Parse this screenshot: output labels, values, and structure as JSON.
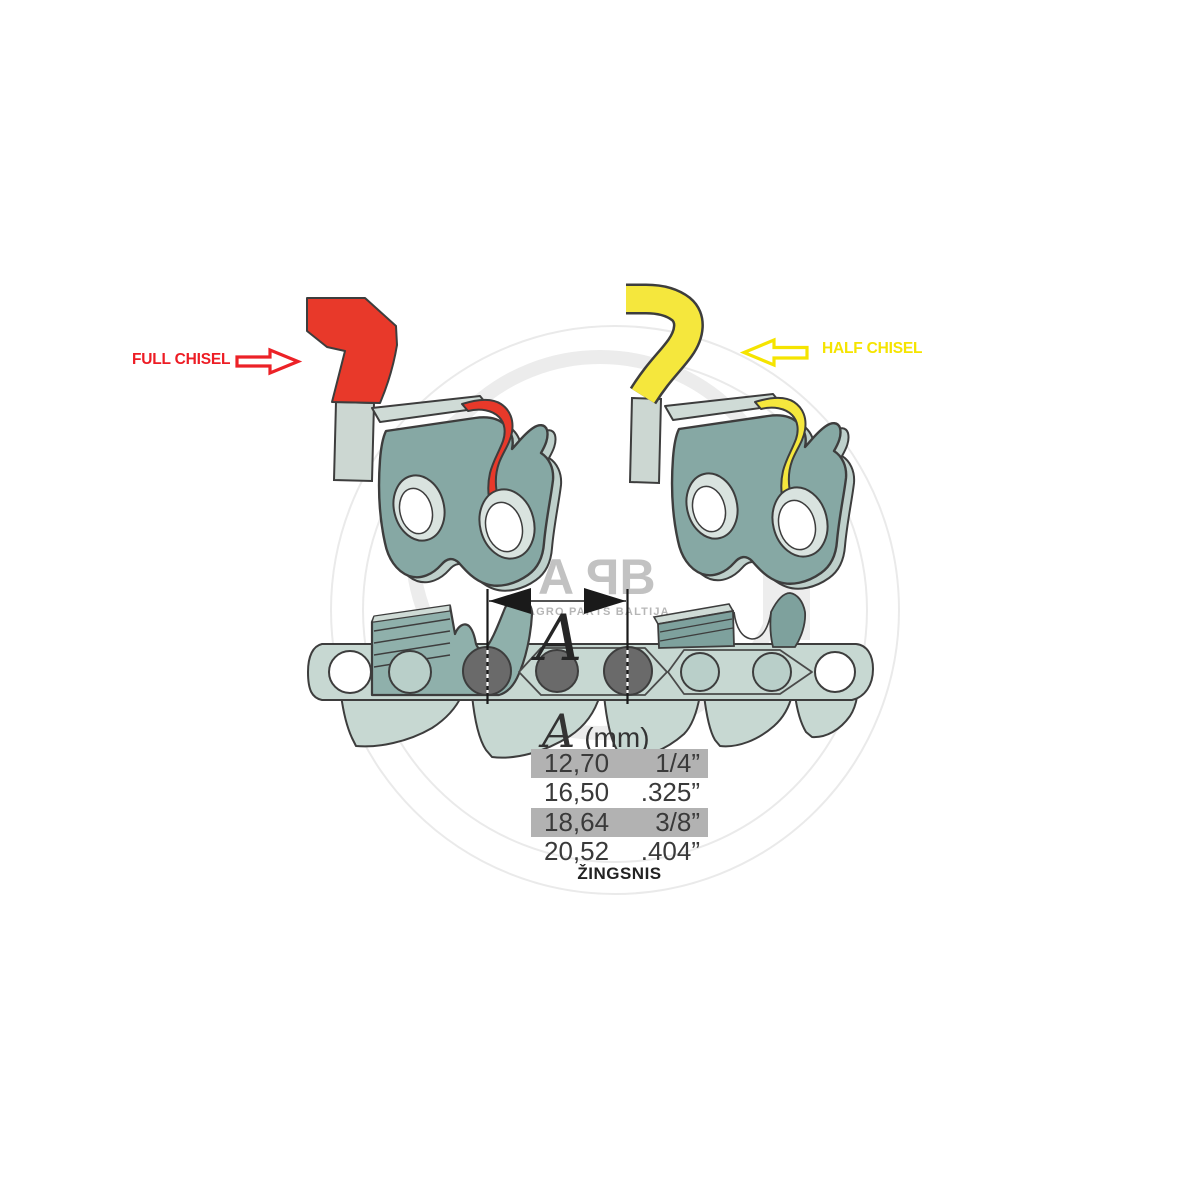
{
  "annotations": {
    "full_chisel_label": "FULL CHISEL",
    "half_chisel_label": "HALF CHISEL",
    "dimension_letter": "A"
  },
  "pitch_table": {
    "header_letter": "A",
    "header_unit": "(mm)",
    "rows": [
      {
        "mm": "12,70",
        "inch": "1/4”",
        "highlighted": true
      },
      {
        "mm": "16,50",
        "inch": ".325”",
        "highlighted": false
      },
      {
        "mm": "18,64",
        "inch": "3/8”",
        "highlighted": true
      },
      {
        "mm": "20,52",
        "inch": ".404”",
        "highlighted": false
      }
    ],
    "caption": "ŽINGSNIS"
  },
  "watermark": {
    "logo_a": "A",
    "logo_p": "P",
    "logo_b": "B",
    "tagline": "AGRO PARTS BALTIJA"
  },
  "icons": {
    "full_chisel_arrow": "arrow-right-outline-icon",
    "half_chisel_arrow": "arrow-left-outline-icon",
    "dimension_arrows": "double-headed-dimension-arrow-icon"
  },
  "colors": {
    "full_chisel_red": "#e8392a",
    "red_text": "#ed1c24",
    "half_chisel_yellow": "#f5e73d",
    "yellow_arrow": "#f5e400",
    "cutter_teal": "#86a8a4",
    "cutter_teal_dark": "#7ea19d",
    "chain_sage": "#c7d8d2",
    "hole_teal": "#b9cfc9",
    "rivet_gray": "#6a6a6a",
    "outline_dark": "#3d3d3d",
    "table_highlight": "#b2b2b2",
    "watermark_gray": "#c2c2c2"
  }
}
